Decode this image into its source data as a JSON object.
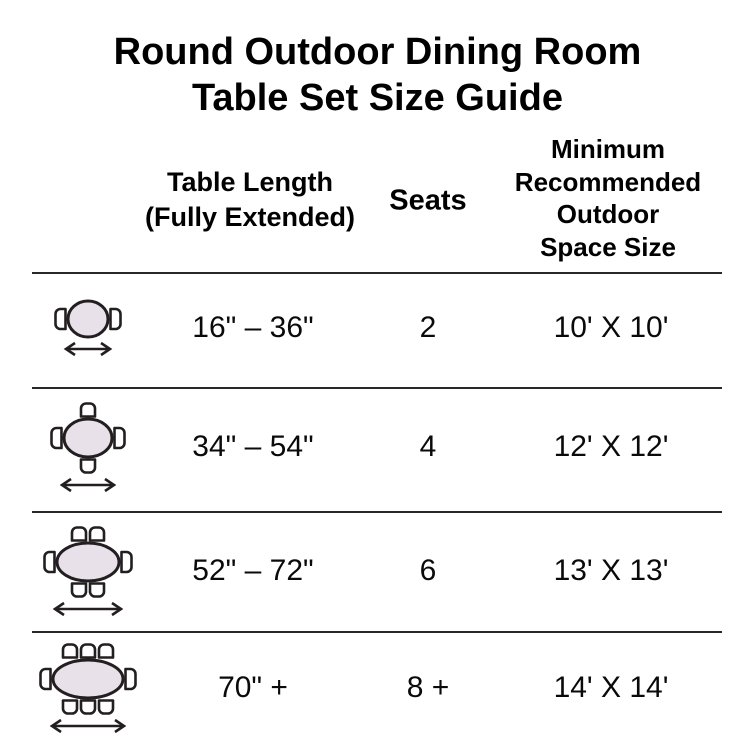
{
  "title": {
    "line1": "Round Outdoor Dining Room",
    "line2": "Table Set Size Guide"
  },
  "columns": {
    "length": "Table Length\n(Fully Extended)",
    "seats": "Seats",
    "space": "Minimum\nRecommended\nOutdoor\nSpace Size"
  },
  "rows": [
    {
      "length": "16\" – 36\"",
      "seats": "2",
      "space": "10' X 10'",
      "icon": "oval-table-2-chairs",
      "icon_cfg": {
        "table_rx": 20,
        "table_ry": 18,
        "top_chairs": 0,
        "bottom_chairs": 0,
        "side_chairs": 2,
        "arrow_half": 22
      }
    },
    {
      "length": "34\" – 54\"",
      "seats": "4",
      "space": "12' X 12'",
      "icon": "oval-table-4-chairs",
      "icon_cfg": {
        "table_rx": 24,
        "table_ry": 19,
        "top_chairs": 1,
        "bottom_chairs": 1,
        "side_chairs": 2,
        "arrow_half": 26
      }
    },
    {
      "length": "52\" – 72\"",
      "seats": "6",
      "space": "13' X 13'",
      "icon": "oval-table-6-chairs",
      "icon_cfg": {
        "table_rx": 31,
        "table_ry": 19,
        "top_chairs": 2,
        "bottom_chairs": 2,
        "side_chairs": 2,
        "arrow_half": 33
      }
    },
    {
      "length": "70\" +",
      "seats": "8 +",
      "space": "14' X 14'",
      "icon": "oval-table-8-chairs",
      "icon_cfg": {
        "table_rx": 35,
        "table_ry": 19,
        "top_chairs": 3,
        "bottom_chairs": 3,
        "side_chairs": 2,
        "arrow_half": 36
      }
    }
  ],
  "style": {
    "table_fill": "#e9e1ea",
    "chair_fill": "#ffffff",
    "line_color": "#231f20",
    "divider_color": "#282828",
    "text_color": "#000000"
  },
  "chart_data": {
    "type": "table",
    "title": "Round Outdoor Dining Room Table Set Size Guide",
    "columns": [
      "Table Length (Fully Extended)",
      "Seats",
      "Minimum Recommended Outdoor Space Size"
    ],
    "rows": [
      [
        "16\" – 36\"",
        "2",
        "10' X 10'"
      ],
      [
        "34\" – 54\"",
        "4",
        "12' X 12'"
      ],
      [
        "52\" – 72\"",
        "6",
        "13' X 13'"
      ],
      [
        "70\" +",
        "8 +",
        "14' X 14'"
      ]
    ],
    "legend": "Row icons depict an oval dining table with 2, 4, 6, or 8 chairs and a horizontal double-headed arrow indicating table length"
  }
}
